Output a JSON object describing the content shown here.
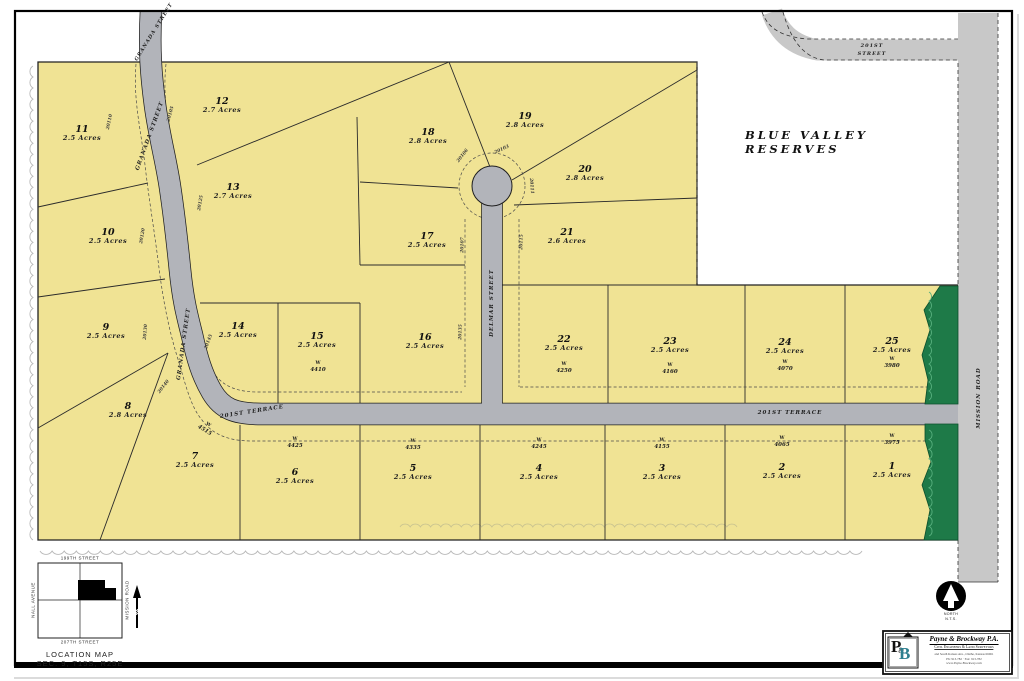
{
  "sheet": {
    "reserve_area_label": "BLUE VALLEY RESERVES",
    "colors": {
      "lot_fill": "#f0e394",
      "onsite_road_fill": "#b2b4ba",
      "offsite_road_fill": "#c8c8c8",
      "tree_buffer_green": "#1e7a48",
      "tree_line_gray": "#b9b9b9",
      "ink": "#1a1a1a"
    },
    "street_labels": [
      {
        "t": "GRANADA STREET",
        "x": 154,
        "y": 32,
        "r": -58,
        "s": 5
      },
      {
        "t": "GRANADA STREET",
        "x": 150,
        "y": 136,
        "r": -70,
        "s": 5.5
      },
      {
        "t": "GRANADA STREET",
        "x": 184,
        "y": 344,
        "r": -82,
        "s": 5.5
      },
      {
        "t": "DELMAR STREET",
        "x": 492,
        "y": 303,
        "r": -90,
        "s": 5.5
      },
      {
        "t": "201ST TERRACE",
        "x": 252,
        "y": 412,
        "r": -9,
        "s": 5.5
      },
      {
        "t": "201ST TERRACE",
        "x": 790,
        "y": 413,
        "r": 0,
        "s": 5.5
      },
      {
        "t": "201ST",
        "x": 872,
        "y": 46,
        "r": 0,
        "s": 5
      },
      {
        "t": "STREET",
        "x": 872,
        "y": 54,
        "r": 0,
        "s": 5
      },
      {
        "t": "MISSION ROAD",
        "x": 979,
        "y": 398,
        "r": -90,
        "s": 5.5
      }
    ],
    "lots": [
      {
        "num": "1",
        "acres": "2.5 Acres",
        "x": 892,
        "y": 468,
        "addr": "3975",
        "ax": 892,
        "ay": 440
      },
      {
        "num": "2",
        "acres": "2.5 Acres",
        "x": 782,
        "y": 469,
        "addr": "4065",
        "ax": 782,
        "ay": 442
      },
      {
        "num": "3",
        "acres": "2.5 Acres",
        "x": 662,
        "y": 470,
        "addr": "4155",
        "ax": 662,
        "ay": 444
      },
      {
        "num": "4",
        "acres": "2.5 Acres",
        "x": 539,
        "y": 470,
        "addr": "4245",
        "ax": 539,
        "ay": 444
      },
      {
        "num": "5",
        "acres": "2.5 Acres",
        "x": 413,
        "y": 470,
        "addr": "4335",
        "ax": 413,
        "ay": 445
      },
      {
        "num": "6",
        "acres": "2.5 Acres",
        "x": 295,
        "y": 474,
        "addr": "4425",
        "ax": 295,
        "ay": 443
      },
      {
        "num": "7",
        "acres": "2.5 Acres",
        "x": 195,
        "y": 458,
        "addr": "4515",
        "ax": 206,
        "ay": 428,
        "arot": 32
      },
      {
        "num": "8",
        "acres": "2.8 Acres",
        "x": 128,
        "y": 408
      },
      {
        "num": "9",
        "acres": "2.5 Acres",
        "x": 106,
        "y": 329
      },
      {
        "num": "10",
        "acres": "2.5 Acres",
        "x": 108,
        "y": 234
      },
      {
        "num": "11",
        "acres": "2.5 Acres",
        "x": 82,
        "y": 131
      },
      {
        "num": "12",
        "acres": "2.7 Acres",
        "x": 222,
        "y": 103
      },
      {
        "num": "13",
        "acres": "2.7 Acres",
        "x": 233,
        "y": 189
      },
      {
        "num": "14",
        "acres": "2.5 Acres",
        "x": 238,
        "y": 328
      },
      {
        "num": "15",
        "acres": "2.5 Acres",
        "x": 317,
        "y": 338,
        "addr": "4410",
        "ax": 318,
        "ay": 367
      },
      {
        "num": "16",
        "acres": "2.5 Acres",
        "x": 425,
        "y": 339
      },
      {
        "num": "17",
        "acres": "2.5 Acres",
        "x": 427,
        "y": 238
      },
      {
        "num": "18",
        "acres": "2.8 Acres",
        "x": 428,
        "y": 134
      },
      {
        "num": "19",
        "acres": "2.8 Acres",
        "x": 525,
        "y": 118
      },
      {
        "num": "20",
        "acres": "2.8 Acres",
        "x": 585,
        "y": 171
      },
      {
        "num": "21",
        "acres": "2.6 Acres",
        "x": 567,
        "y": 234
      },
      {
        "num": "22",
        "acres": "2.5 Acres",
        "x": 564,
        "y": 341,
        "addr": "4250",
        "ax": 564,
        "ay": 368
      },
      {
        "num": "23",
        "acres": "2.5 Acres",
        "x": 670,
        "y": 343,
        "addr": "4160",
        "ax": 670,
        "ay": 369
      },
      {
        "num": "24",
        "acres": "2.5 Acres",
        "x": 785,
        "y": 344,
        "addr": "4070",
        "ax": 785,
        "ay": 366
      },
      {
        "num": "25",
        "acres": "2.5 Acres",
        "x": 892,
        "y": 343,
        "addr": "3980",
        "ax": 892,
        "ay": 363
      }
    ],
    "address_numbers_street": [
      {
        "t": "20110",
        "x": 110,
        "y": 122,
        "r": -78
      },
      {
        "t": "20105",
        "x": 171,
        "y": 114,
        "r": -75
      },
      {
        "t": "20125",
        "x": 201,
        "y": 203,
        "r": -80
      },
      {
        "t": "20120",
        "x": 143,
        "y": 236,
        "r": -80
      },
      {
        "t": "20130",
        "x": 146,
        "y": 332,
        "r": -85
      },
      {
        "t": "20145",
        "x": 209,
        "y": 342,
        "r": -70
      },
      {
        "t": "20140",
        "x": 164,
        "y": 387,
        "r": -52
      },
      {
        "t": "20106",
        "x": 463,
        "y": 156,
        "r": -52
      },
      {
        "t": "20103",
        "x": 502,
        "y": 150,
        "r": -25
      },
      {
        "t": "20111",
        "x": 531,
        "y": 186,
        "r": 85
      },
      {
        "t": "20107",
        "x": 463,
        "y": 245,
        "r": -88
      },
      {
        "t": "20115",
        "x": 522,
        "y": 242,
        "r": -88
      },
      {
        "t": "20135",
        "x": 461,
        "y": 332,
        "r": -88
      }
    ]
  },
  "location_map": {
    "top_street": "199TH STREET",
    "bottom_street": "207TH STREET",
    "left_street": "NALL AVENUE",
    "right_street": "MISSION ROAD",
    "title": "LOCATION MAP",
    "subtitle": "SEC. 9, T15S, R25E"
  },
  "north_arrow": {
    "label": "NORTH",
    "scale_note": "N.T.S."
  },
  "stamp": {
    "company": "Payne & Brockway P.A.",
    "tagline": "Civil Engineers & Land Surveyors",
    "address_line": "and South Kansas Ave., Olathe, Kansas 66061",
    "phone_line": "Ph: 913-782 · Fax: 913-782",
    "web_line": "www.Payne-Brockway.com",
    "logo_letters": "P&B"
  }
}
